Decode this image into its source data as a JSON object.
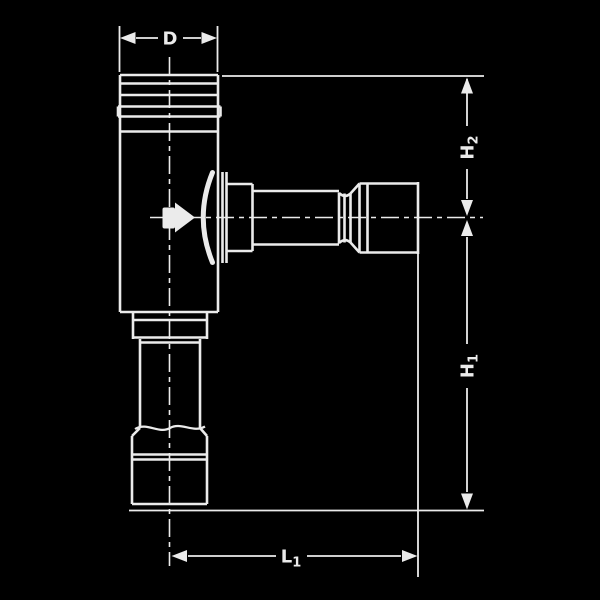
{
  "drawing": {
    "kind": "technical-line-drawing",
    "subject": "angle valve / flush valve with vertical pipe and horizontal outlet, shown with dimension annotations",
    "colors": {
      "background": "#000000",
      "line": "#ebebeb"
    },
    "labels": {
      "diameter": {
        "main": "D",
        "sub": ""
      },
      "height_upper": {
        "main": "H",
        "sub": "2"
      },
      "height_lower": {
        "main": "H",
        "sub": "1"
      },
      "length": {
        "main": "L",
        "sub": "1"
      }
    }
  }
}
